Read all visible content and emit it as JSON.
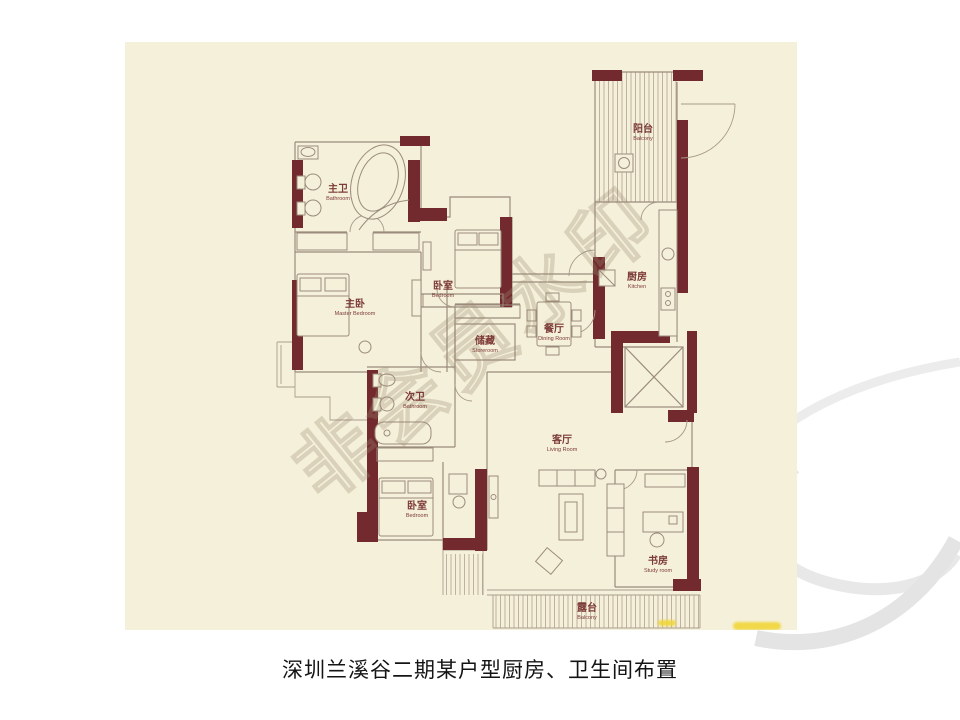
{
  "slide": {
    "caption": "深圳兰溪谷二期某户型厨房、卫生间布置"
  },
  "floor_plan": {
    "watermark": "非会员水印",
    "rooms": [
      {
        "zh": "主卫",
        "en": "Bathroom"
      },
      {
        "zh": "主卧",
        "en": "Master Bedroom"
      },
      {
        "zh": "卧室",
        "en": "Bedroom"
      },
      {
        "zh": "储藏",
        "en": "Storeroom"
      },
      {
        "zh": "餐厅",
        "en": "Dining Room"
      },
      {
        "zh": "厨房",
        "en": "Kitchen"
      },
      {
        "zh": "阳台",
        "en": "Balcony"
      },
      {
        "zh": "次卫",
        "en": "Bathroom"
      },
      {
        "zh": "卧室",
        "en": "Bedroom"
      },
      {
        "zh": "客厅",
        "en": "Living Room"
      },
      {
        "zh": "书房",
        "en": "Study room"
      },
      {
        "zh": "露台",
        "en": "Balcony"
      }
    ],
    "colors": {
      "wall": "#722a2e",
      "floor": "#f5f0da",
      "thin_line": "#9b8b7c",
      "label": "#7c3b37",
      "watermark": "#9a8a72",
      "highlight": "#f0d63a",
      "background_top": "#e2e2f6",
      "caption_text": "#141414"
    }
  }
}
